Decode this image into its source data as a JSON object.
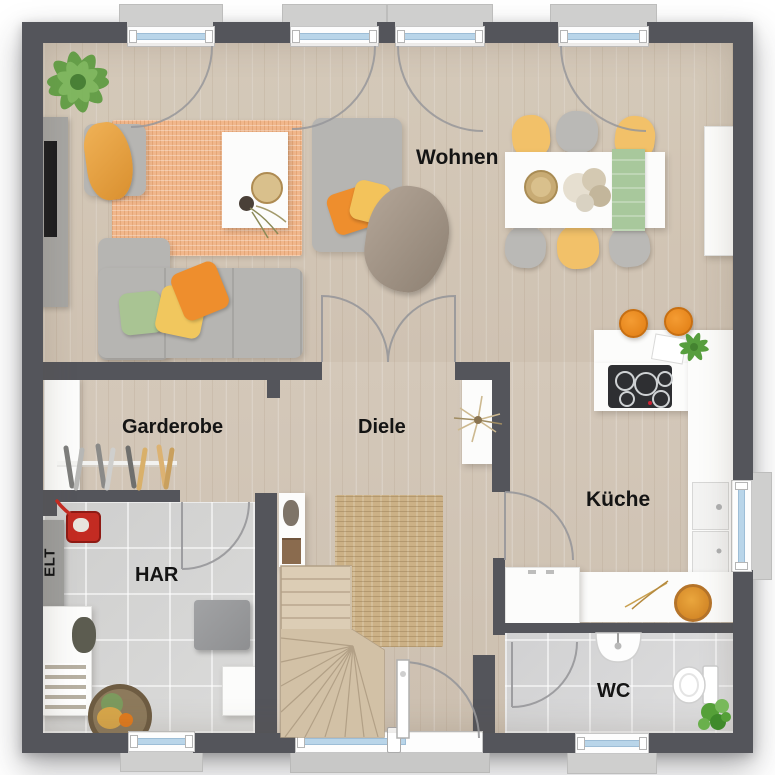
{
  "rooms": {
    "wohnen": {
      "label": "Wohnen"
    },
    "garderobe": {
      "label": "Garderobe"
    },
    "diele": {
      "label": "Diele"
    },
    "kueche": {
      "label": "Küche"
    },
    "har": {
      "label": "HAR"
    },
    "elt": {
      "label": "ELT"
    },
    "wc": {
      "label": "WC"
    }
  },
  "palette": {
    "wall": "#54555b",
    "wood_floor": "#d6cabb",
    "tile_floor": "#d9d9d8",
    "window_glass": "#b9d5e9",
    "rug_living": "#f1b78c",
    "rug_hall": "#ccb186",
    "sofa_gray": "#b6b5b2",
    "accent_orange": "#ee8e2d",
    "accent_yellow": "#f2c169",
    "accent_green": "#a9c493",
    "plant_green": "#5d9b40",
    "furniture_white": "#fcfcfb"
  }
}
